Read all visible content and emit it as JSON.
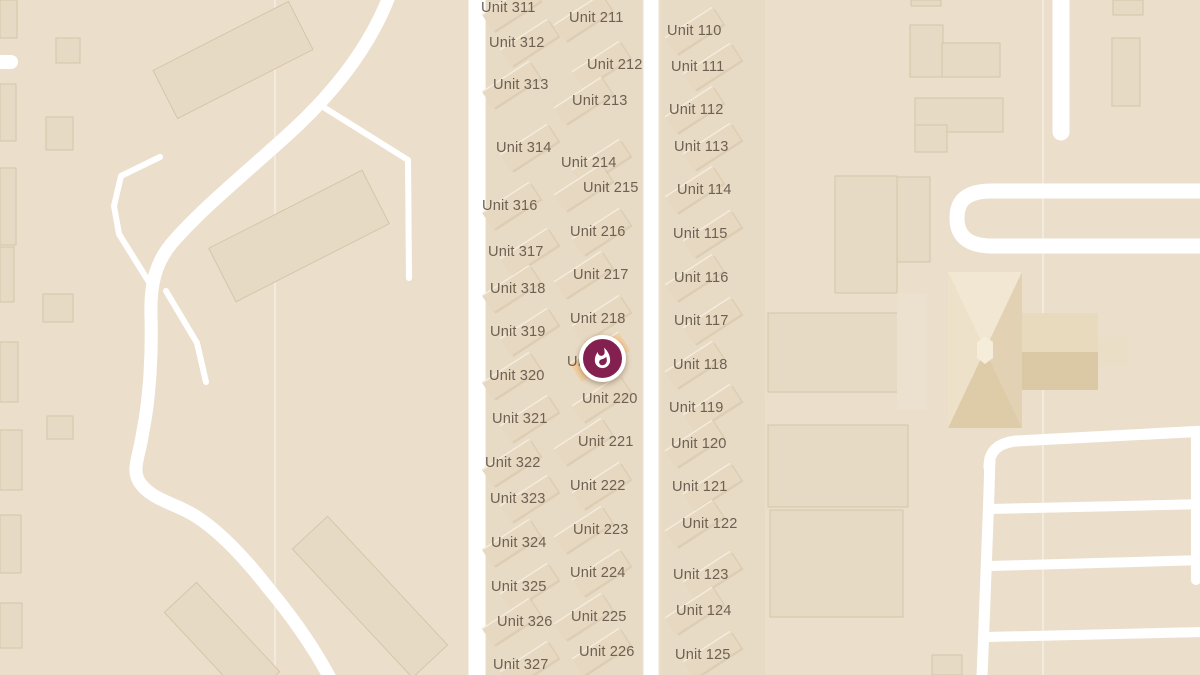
{
  "map": {
    "width": 1200,
    "height": 675,
    "colors": {
      "background": "#ebdfcc",
      "parcel": "#e8dbc5",
      "road": "#ffffff",
      "building": "#e7dac4",
      "building_light": "#ece1cf",
      "building_border": "#d6c5a8",
      "unit_building": "#e6d8c1",
      "unit_building_shadow": "#d0bd9f",
      "unit_building_edge": "#f4ecdc",
      "label_text": "#6e6152",
      "marker_fill": "#84204f",
      "marker_ring": "#ffffff",
      "highlight_unit": "#f2d0a2",
      "boundary_line": "#f4ecdd"
    },
    "marker": {
      "icon": "fire-icon",
      "x": 602,
      "y": 358,
      "covered_label": "Unit 219"
    }
  },
  "units": {
    "col3": {
      "rect_x": 520,
      "labels": [
        [
          "Unit 311",
          481,
          0
        ],
        [
          "Unit 312",
          489,
          35
        ],
        [
          "Unit 313",
          493,
          77
        ],
        [
          "Unit 314",
          496,
          140
        ],
        [
          "Unit 316",
          482,
          198
        ],
        [
          "Unit 317",
          488,
          244
        ],
        [
          "Unit 318",
          490,
          281
        ],
        [
          "Unit 319",
          490,
          324
        ],
        [
          "Unit 320",
          489,
          368
        ],
        [
          "Unit 321",
          492,
          411
        ],
        [
          "Unit 322",
          485,
          455
        ],
        [
          "Unit 323",
          490,
          491
        ],
        [
          "Unit 324",
          491,
          535
        ],
        [
          "Unit 325",
          491,
          579
        ],
        [
          "Unit 326",
          497,
          614
        ],
        [
          "Unit 327",
          493,
          657
        ]
      ]
    },
    "col2": {
      "rect_x": 592,
      "labels": [
        [
          "Unit 211",
          569,
          10
        ],
        [
          "Unit 212",
          587,
          57
        ],
        [
          "Unit 213",
          572,
          93
        ],
        [
          "Unit 214",
          561,
          155
        ],
        [
          "Unit 215",
          583,
          180
        ],
        [
          "Unit 216",
          570,
          224
        ],
        [
          "Unit 217",
          573,
          267
        ],
        [
          "Unit 218",
          570,
          311
        ],
        [
          "Unit 219",
          567,
          354
        ],
        [
          "Unit 220",
          582,
          391
        ],
        [
          "Unit 221",
          578,
          434
        ],
        [
          "Unit 222",
          570,
          478
        ],
        [
          "Unit 223",
          573,
          522
        ],
        [
          "Unit 224",
          570,
          565
        ],
        [
          "Unit 225",
          571,
          609
        ],
        [
          "Unit 226",
          579,
          644
        ]
      ]
    },
    "col1": {
      "rect_x": 703,
      "labels": [
        [
          "Unit 110",
          667,
          23
        ],
        [
          "Unit 111",
          671,
          59
        ],
        [
          "Unit 112",
          669,
          102
        ],
        [
          "Unit 113",
          674,
          139
        ],
        [
          "Unit 114",
          677,
          182
        ],
        [
          "Unit 115",
          673,
          226
        ],
        [
          "Unit 116",
          674,
          270
        ],
        [
          "Unit 117",
          674,
          313
        ],
        [
          "Unit 118",
          673,
          357
        ],
        [
          "Unit 119",
          669,
          400
        ],
        [
          "Unit 120",
          671,
          436
        ],
        [
          "Unit 121",
          672,
          479
        ],
        [
          "Unit 122",
          682,
          516
        ],
        [
          "Unit 123",
          673,
          567
        ],
        [
          "Unit 124",
          676,
          603
        ],
        [
          "Unit 125",
          675,
          647
        ]
      ]
    }
  },
  "shapes": {
    "parcels": [
      [
        486,
        0,
        156,
        675
      ],
      [
        661,
        0,
        104,
        675
      ]
    ],
    "boundary_lines": [
      "M 275 0 L 275 675",
      "M 1043 0 L 1043 675"
    ],
    "buildings": [
      [
        0,
        0,
        17,
        38
      ],
      [
        56,
        38,
        24,
        25
      ],
      [
        0,
        84,
        16,
        57
      ],
      [
        46,
        117,
        27,
        33
      ],
      [
        0,
        168,
        16,
        77
      ],
      [
        0,
        247,
        14,
        55
      ],
      [
        43,
        294,
        30,
        28
      ],
      [
        0,
        342,
        18,
        60
      ],
      [
        47,
        416,
        26,
        23
      ],
      [
        0,
        430,
        22,
        60
      ],
      [
        0,
        515,
        21,
        58
      ],
      [
        0,
        603,
        22,
        45
      ],
      [
        911,
        0,
        30,
        6
      ],
      [
        910,
        25,
        33,
        52
      ],
      [
        942,
        43,
        58,
        34
      ],
      [
        915,
        98,
        88,
        34
      ],
      [
        915,
        125,
        32,
        27
      ],
      [
        1113,
        0,
        30,
        15
      ],
      [
        1112,
        38,
        28,
        68
      ],
      [
        835,
        176,
        62,
        117
      ],
      [
        897,
        177,
        33,
        85
      ],
      [
        768,
        313,
        139,
        79
      ],
      [
        768,
        425,
        140,
        82
      ],
      [
        770,
        510,
        133,
        107
      ],
      [
        932,
        655,
        30,
        20
      ]
    ],
    "buildings_light": [
      [
        897,
        293,
        30,
        117
      ]
    ],
    "buildings_rotated": [
      [
        233,
        60,
        152,
        54,
        -27
      ],
      [
        299,
        236,
        172,
        60,
        -27
      ],
      [
        370,
        597,
        176,
        48,
        47
      ],
      [
        222,
        642,
        122,
        44,
        47
      ]
    ],
    "pinwheel": [
      {
        "p": "948,272 1022,272 1022,428 948,428",
        "f": "#e9dcc0"
      },
      {
        "p": "948,272 1022,272 985,350",
        "f": "#f1e7d2"
      },
      {
        "p": "1022,272 1022,428 985,350",
        "f": "#e2d1b2"
      },
      {
        "p": "1022,428 948,428 985,350",
        "f": "#decca9"
      },
      {
        "p": "948,428 948,272 985,350",
        "f": "#ede1ca"
      },
      {
        "p": "1022,313 1098,313 1098,352 1022,352",
        "f": "#e8dabd"
      },
      {
        "p": "1022,352 1098,352 1098,390 1022,390",
        "f": "#dbc8a4"
      },
      {
        "p": "1098,337 1128,337 1128,366 1098,366",
        "f": "#eadec6"
      },
      {
        "p": "977,342 985,336 993,342 993,358 985,364 977,358",
        "f": "#f5ecd9"
      }
    ],
    "roads": [
      {
        "d": "M 390 -6 C 372 42 340 86 295 128 C 252 168 205 205 172 243 C 155 263 150 286 151 316 C 152 352 150 396 143 431 C 139 458 131 470 140 483 C 153 501 176 503 197 517 C 223 534 248 562 269 589 C 289 613 313 646 331 680",
        "w": 13
      },
      {
        "d": "M 160 157 L 121 176 L 114 206 L 119 234 L 152 287",
        "w": 6
      },
      {
        "d": "M 166 291 L 197 343 L 206 382",
        "w": 6
      },
      {
        "d": "M -6 62 L 11 62",
        "w": 14
      },
      {
        "d": "M 320 105 L 408 160 L 409 278",
        "w": 6
      },
      {
        "d": "M 477 -6 L 477 681",
        "w": 17
      },
      {
        "d": "M 651 -6 L 651 681",
        "w": 15
      },
      {
        "d": "M 1061 -6 L 1061 132",
        "w": 17
      },
      {
        "d": "M 1206 191 L 992 191 C 966 191 957 201 957 218 C 957 236 968 246 992 246 L 1206 246",
        "w": 15
      },
      {
        "d": "M 990 458 C 988 530 985 600 982 678",
        "w": 11
      },
      {
        "d": "M 989 467 C 989 450 999 443 1016 441 L 1206 431",
        "w": 11
      },
      {
        "d": "M 991 509 L 1206 504",
        "w": 10
      },
      {
        "d": "M 989 566 L 1206 560",
        "w": 10
      },
      {
        "d": "M 986 637 L 1206 632",
        "w": 10
      },
      {
        "d": "M 1196 436 L 1196 580",
        "w": 10
      }
    ]
  }
}
